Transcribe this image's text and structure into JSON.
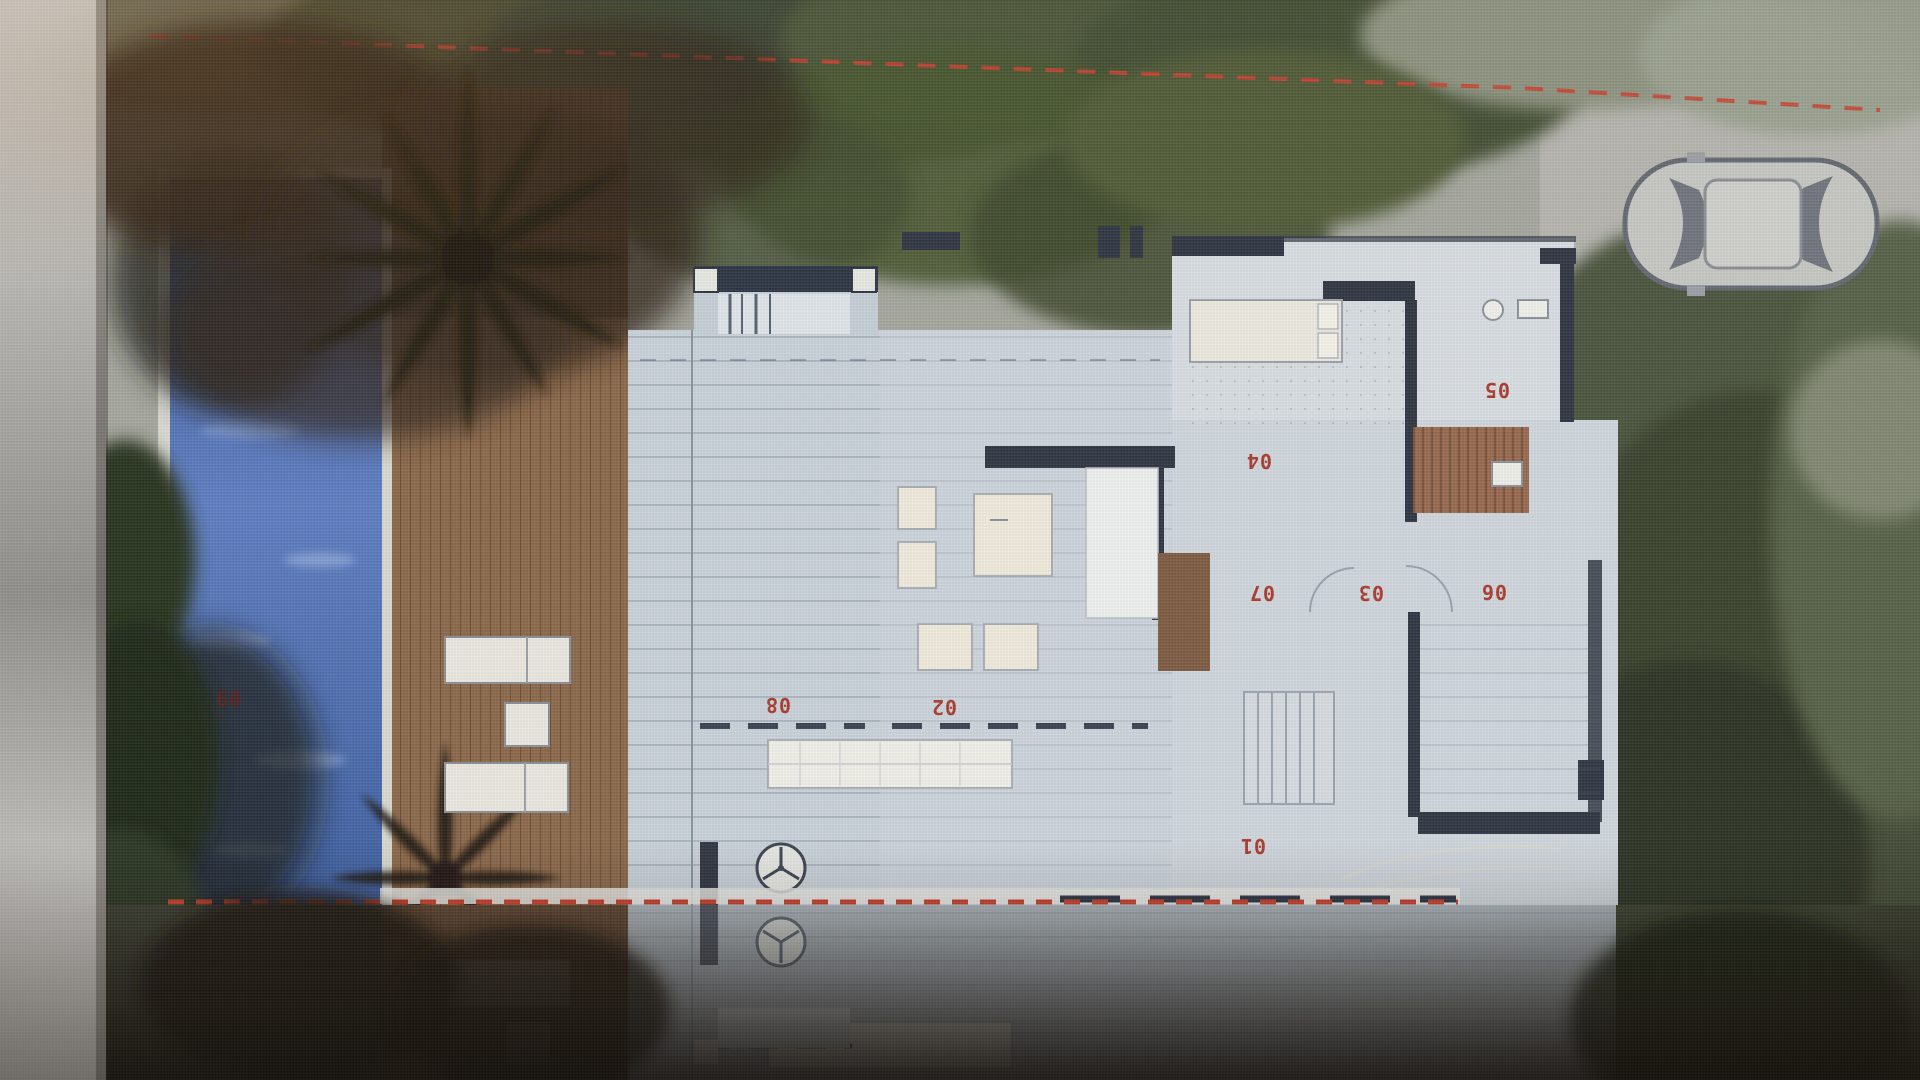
{
  "plan": {
    "room_labels": [
      {
        "area": "deck-lounge",
        "num": "08"
      },
      {
        "area": "living-terrace",
        "num": "02"
      },
      {
        "area": "bedroom",
        "num": "04"
      },
      {
        "area": "bathroom",
        "num": "05"
      },
      {
        "area": "hall",
        "num": "07"
      },
      {
        "area": "corridor",
        "num": "03"
      },
      {
        "area": "garage-room",
        "num": "06"
      },
      {
        "area": "entry-terrace",
        "num": "01"
      },
      {
        "area": "pool",
        "num": "09"
      }
    ],
    "label_color": "#a8392c",
    "pool_label_color": "#571f18",
    "boundary_color": "#c8402e"
  },
  "colors": {
    "pool_blue": "#44619f",
    "deck_brown": "#8a6749",
    "slab_gray": "#c9d2d9",
    "wall_dark": "#2b3342",
    "foliage_green": "#46503a",
    "car_body": "#c6c7c2"
  }
}
